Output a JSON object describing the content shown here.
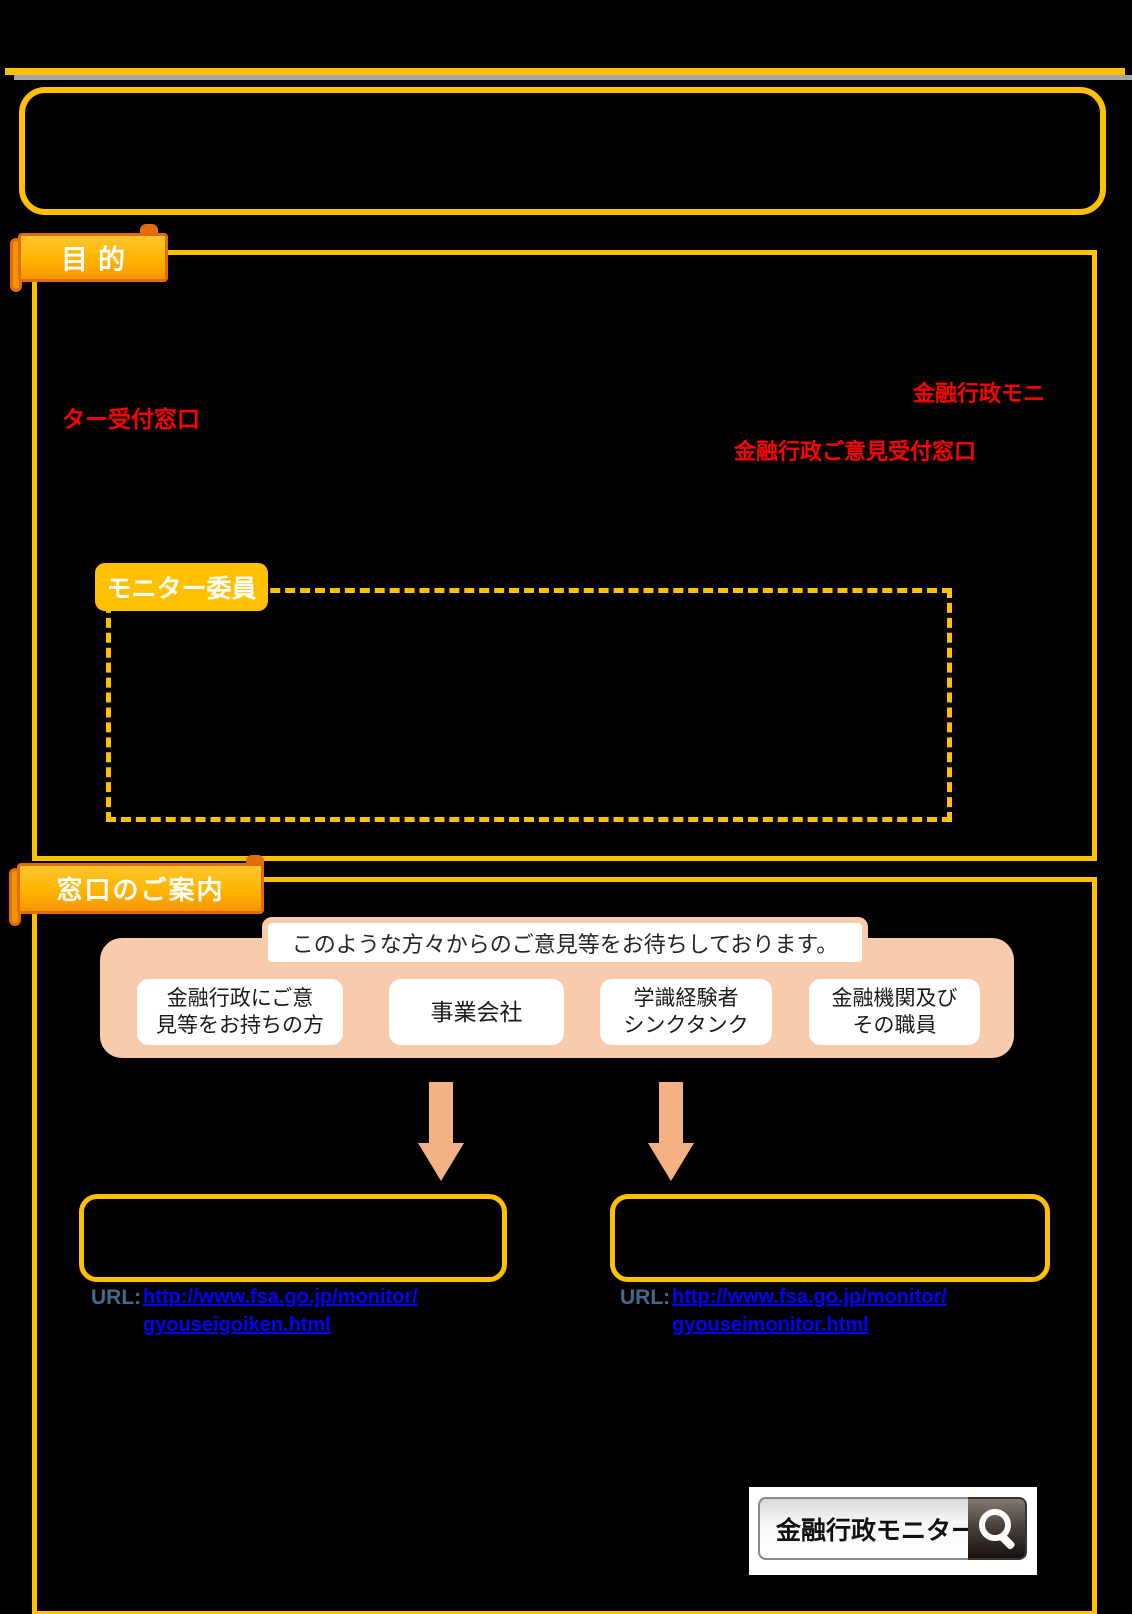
{
  "colors": {
    "background": "#000000",
    "accent_gold": "#FFC000",
    "ribbon_border_orange": "#E36C09",
    "gray_line": "#A6A6A6",
    "peach": "#F8CBAD",
    "arrow_peach": "#F4B183",
    "red_text": "#FF0000",
    "url_label_blue_gray": "#44698D",
    "link_blue": "#0000FF"
  },
  "purpose": {
    "ribbon_label": "目的",
    "red_line1": "金融行政モニ",
    "red_line2": "ター受付窓口",
    "red_line3": "金融行政ご意見受付窓口",
    "monitor_label": "モニター委員"
  },
  "guide": {
    "ribbon_label": "窓口のご案内",
    "headline": "このような方々からのご意見等をお待ちしております。",
    "audience": [
      {
        "line1": "金融行政にご意",
        "line2": "見等をお持ちの方"
      },
      {
        "line1": "事業会社",
        "line2": ""
      },
      {
        "line1": "学識経験者",
        "line2": "シンクタンク"
      },
      {
        "line1": "金融機関及び",
        "line2": "その職員"
      }
    ],
    "left_channel": {
      "url_label": "URL:",
      "url_line1": "http://www.fsa.go.jp/monitor/",
      "url_line2": "gyouseigoiken.html"
    },
    "right_channel": {
      "url_label": "URL:",
      "url_line1": "http://www.fsa.go.jp/monitor/",
      "url_line2": "gyouseimonitor.html"
    },
    "search": {
      "query": "金融行政モニター"
    }
  }
}
